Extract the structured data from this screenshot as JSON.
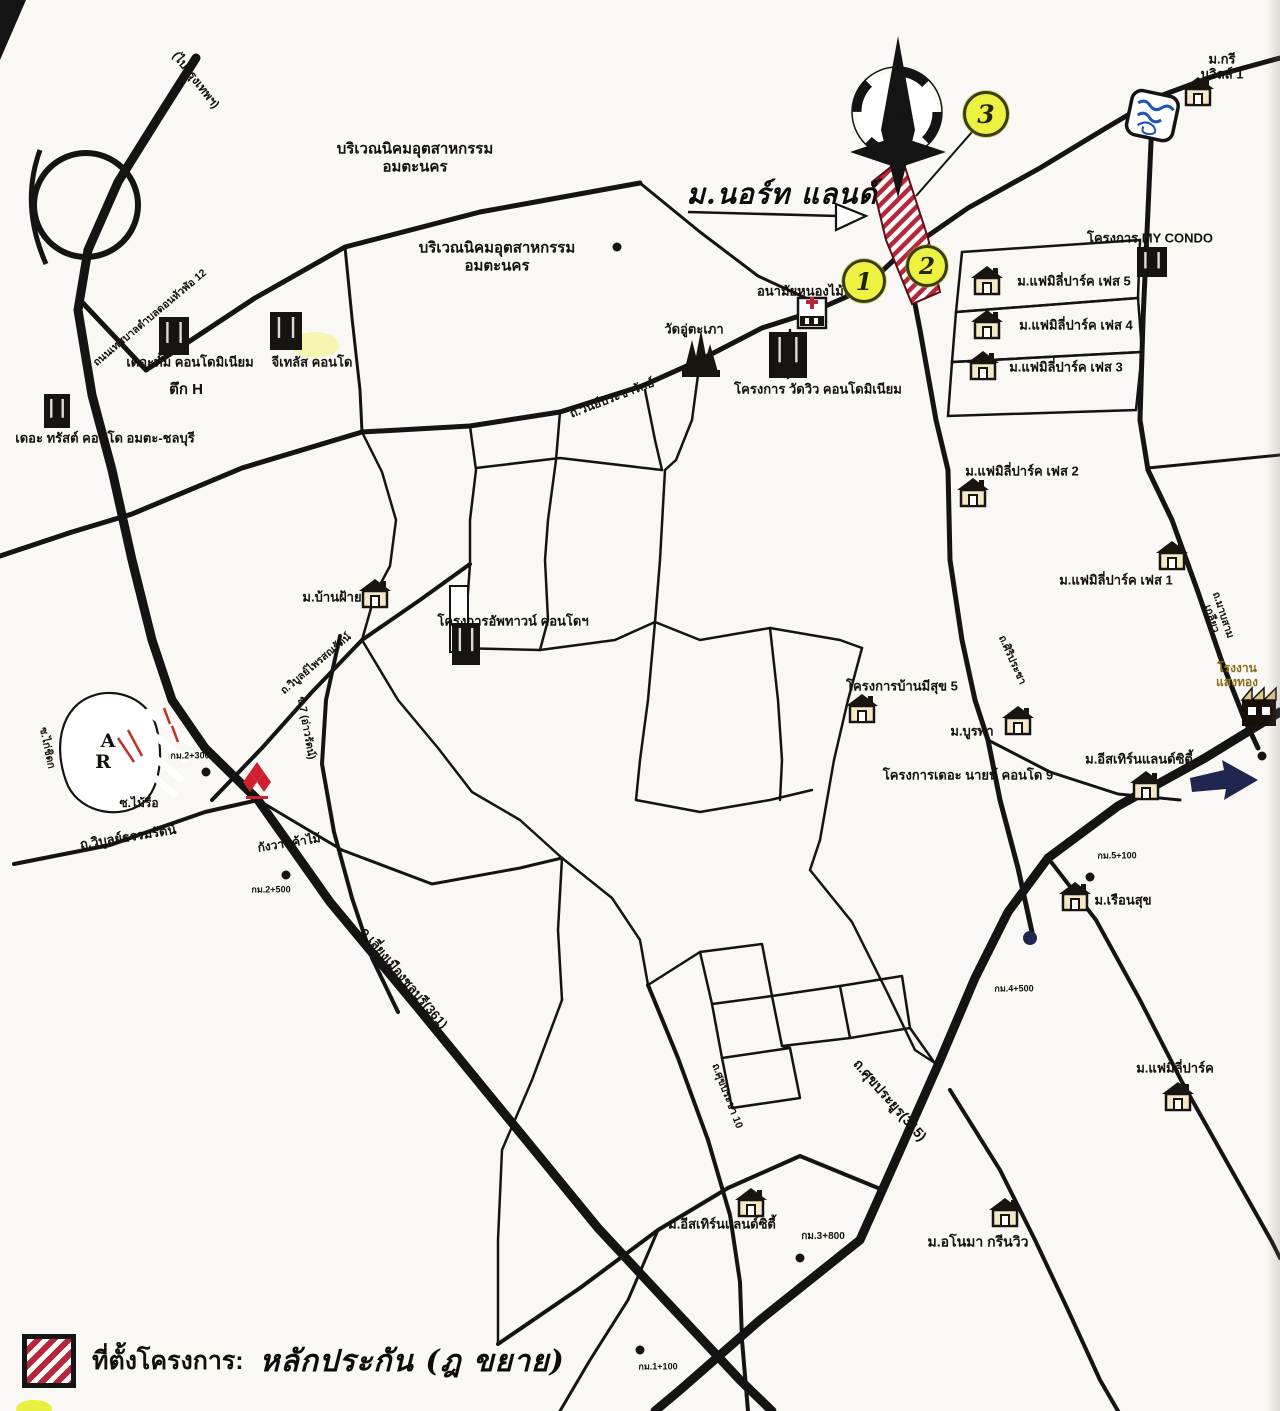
{
  "map": {
    "compass_label": "N",
    "site_annotation": "ม.นอร์ท แลนด์",
    "legend": {
      "swatch": "red-white-diagonal-stripes",
      "label_printed": "ที่ตั้งโครงการ:",
      "label_handwritten": "หลักประกัน (ฎ ขยาย)"
    },
    "colors": {
      "paper": "#f9f8f4",
      "road_black": "#141414",
      "hatch_red": "#b5283a",
      "highlight_yellow": "#edf240",
      "water_blue": "#2053b8",
      "arrow_navy": "#20264f",
      "mitsubishi_red": "#cf2030",
      "factory_text": "#8a6d1a"
    },
    "markers": [
      {
        "n": "1",
        "x": 864,
        "y": 281,
        "r": 19
      },
      {
        "n": "2",
        "x": 927,
        "y": 266,
        "r": 18
      },
      {
        "n": "3",
        "x": 986,
        "y": 114,
        "r": 20
      }
    ],
    "labels": [
      {
        "name": "industrial-estate-1",
        "text": "บริเวณนิคมอุตสาหกรรม\nอมตะนคร",
        "x": 415,
        "y": 158,
        "s": 15,
        "b": 1
      },
      {
        "name": "industrial-estate-2",
        "text": "บริเวณนิคมอุตสาหกรรม\nอมตะนคร",
        "x": 497,
        "y": 257,
        "s": 15,
        "b": 1
      },
      {
        "name": "to-bangkok",
        "text": "(ไปกรุงเทพฯ)",
        "x": 196,
        "y": 80,
        "s": 12,
        "b": 1,
        "r": 52
      },
      {
        "name": "road-thetsaban-12",
        "text": "ถนนเทศบาลตำบลดอนหัวฬ่อ 12",
        "x": 150,
        "y": 318,
        "s": 10.5,
        "b": 1,
        "r": -40
      },
      {
        "name": "the-thum-condo",
        "text": "เดอะทั้ม คอนโดมิเนียม",
        "x": 190,
        "y": 362,
        "s": 13,
        "b": 1
      },
      {
        "name": "tower-h",
        "text": "ตึก H",
        "x": 186,
        "y": 390,
        "s": 15,
        "b": 1
      },
      {
        "name": "g-plus-condo",
        "text": "จีเทลัส คอนโด",
        "x": 312,
        "y": 362,
        "s": 13,
        "b": 1
      },
      {
        "name": "the-trust-condo",
        "text": "เดอะ ทรัสต์ คอนโด อมตะ-ชลบุรี",
        "x": 105,
        "y": 438,
        "s": 13,
        "b": 1
      },
      {
        "name": "north-land-annotation",
        "text": "ม.นอร์ท แลนด์",
        "x": 782,
        "y": 194,
        "s": 28,
        "hw": 1
      },
      {
        "name": "green-ville-1",
        "text": "ม.กรีนวิลล์ 1",
        "x": 1222,
        "y": 67,
        "s": 13,
        "b": 1
      },
      {
        "name": "my-condo",
        "text": "โครงการ MY CONDO",
        "x": 1150,
        "y": 238,
        "s": 13,
        "b": 1
      },
      {
        "name": "family-park-5",
        "text": "ม.แฟมิลี่ปาร์ค เฟส 5",
        "x": 1074,
        "y": 281,
        "s": 13,
        "b": 1
      },
      {
        "name": "family-park-4",
        "text": "ม.แฟมิลี่ปาร์ค เฟส 4",
        "x": 1076,
        "y": 325,
        "s": 13,
        "b": 1
      },
      {
        "name": "family-park-3",
        "text": "ม.แฟมิลี่ปาร์ค เฟส 3",
        "x": 1066,
        "y": 367,
        "s": 13,
        "b": 1
      },
      {
        "name": "family-park-2",
        "text": "ม.แฟมิลี่ปาร์ค เฟส 2",
        "x": 1022,
        "y": 471,
        "s": 13,
        "b": 1
      },
      {
        "name": "family-park-1",
        "text": "ม.แฟมิลี่ปาร์ค เฟส 1",
        "x": 1116,
        "y": 580,
        "s": 13,
        "b": 1
      },
      {
        "name": "anamai-nong-mai-daeng",
        "text": "อนามัยหนองไม้แดง",
        "x": 812,
        "y": 291,
        "s": 13,
        "b": 1
      },
      {
        "name": "wat-u-taphao",
        "text": "วัดอู่ตะเภา",
        "x": 694,
        "y": 329,
        "s": 13,
        "b": 1
      },
      {
        "name": "wat-view-condo",
        "text": "โครงการ วัดวิว คอนโดมิเนียม",
        "x": 818,
        "y": 389,
        "s": 13,
        "b": 1
      },
      {
        "name": "road-winprachairak",
        "text": "ถ.วินย์ประชารักษ์",
        "x": 612,
        "y": 398,
        "s": 12,
        "b": 1,
        "r": -21
      },
      {
        "name": "ban-fai",
        "text": "ม.บ้านฝ้าย",
        "x": 332,
        "y": 597,
        "s": 13,
        "b": 1
      },
      {
        "name": "uptown-condo",
        "text": "โครงการอัพทาวน์ คอนโดฯ",
        "x": 513,
        "y": 621,
        "s": 13,
        "b": 1
      },
      {
        "name": "road-phaisonrat",
        "text": "ถ.วิบูลย์ไพรสณรัตน์",
        "x": 316,
        "y": 664,
        "s": 10.5,
        "b": 1,
        "r": -40
      },
      {
        "name": "soi-7",
        "text": "ซ.7 (อ่าวรัตน์)",
        "x": 306,
        "y": 728,
        "s": 10.5,
        "b": 1,
        "r": 80
      },
      {
        "name": "soi-kai-chidok",
        "text": "ซ.ไก่ชิดก",
        "x": 47,
        "y": 748,
        "s": 10.5,
        "b": 1,
        "r": 78
      },
      {
        "name": "letter-a",
        "text": "A",
        "x": 108,
        "y": 741,
        "s": 19,
        "serif": 1
      },
      {
        "name": "letter-r",
        "text": "R",
        "x": 103,
        "y": 762,
        "s": 19,
        "serif": 1
      },
      {
        "name": "km-2-300",
        "text": "กม.2+300",
        "x": 190,
        "y": 756,
        "s": 9,
        "b": 1
      },
      {
        "name": "soi-mai-rue",
        "text": "ซ.ไม้รื่อ",
        "x": 139,
        "y": 803,
        "s": 12,
        "b": 1
      },
      {
        "name": "road-wibun-thammarat",
        "text": "ถ.วิบูลย์ธรรมรัตน์",
        "x": 128,
        "y": 837,
        "s": 13,
        "b": 1,
        "r": -9
      },
      {
        "name": "kangwan-kha-mai",
        "text": "กังวานค้าไม้",
        "x": 289,
        "y": 843,
        "s": 12,
        "b": 1,
        "r": -9
      },
      {
        "name": "km-2-500",
        "text": "กม.2+500",
        "x": 271,
        "y": 890,
        "s": 9,
        "b": 1
      },
      {
        "name": "road-bypass-361",
        "text": "ถ.เลี่ยงเมืองชลบุรี(361)",
        "x": 404,
        "y": 978,
        "s": 13,
        "b": 1,
        "r": 50
      },
      {
        "name": "baan-mee-suk-5",
        "text": "โครงการบ้านมีสุข 5",
        "x": 902,
        "y": 686,
        "s": 13,
        "b": 1
      },
      {
        "name": "burapha",
        "text": "ม.บูรพา",
        "x": 972,
        "y": 731,
        "s": 13,
        "b": 1
      },
      {
        "name": "the-nine-condo-9",
        "text": "โครงการเดอะ นายน์ คอนโด 9",
        "x": 968,
        "y": 775,
        "s": 13,
        "b": 1
      },
      {
        "name": "eastern-land-city-1",
        "text": "ม.อีสเทิร์นแลนด์ซิตี้",
        "x": 1139,
        "y": 759,
        "s": 13,
        "b": 1
      },
      {
        "name": "road-siripracha",
        "text": "ถ.ศิริประชา",
        "x": 1012,
        "y": 660,
        "s": 10.5,
        "b": 1,
        "r": 66
      },
      {
        "name": "saeng-thong-factory",
        "text": "โรงงานแสงทอง",
        "x": 1237,
        "y": 675,
        "s": 12,
        "b": 1,
        "col": "#8a6d1a"
      },
      {
        "name": "road-mab-sam-kliao",
        "text": "ถ.มาบสามเกลียว",
        "x": 1217,
        "y": 617,
        "s": 10.5,
        "b": 1,
        "r": 72
      },
      {
        "name": "km-5-100",
        "text": "กม.5+100",
        "x": 1117,
        "y": 856,
        "s": 9,
        "b": 1
      },
      {
        "name": "ruen-suk",
        "text": "ม.เรือนสุข",
        "x": 1123,
        "y": 900,
        "s": 13,
        "b": 1
      },
      {
        "name": "km-4-500",
        "text": "กม.4+500",
        "x": 1014,
        "y": 989,
        "s": 9,
        "b": 1
      },
      {
        "name": "family-park-bottom-right",
        "text": "ม.แฟมิลี่ปาร์ค",
        "x": 1175,
        "y": 1068,
        "s": 13,
        "b": 1
      },
      {
        "name": "road-sukprayoon-315",
        "text": "ถ.ศุขประยูร(315)",
        "x": 890,
        "y": 1100,
        "s": 14,
        "b": 1,
        "r": 49
      },
      {
        "name": "road-sukpracha-10",
        "text": "ถ.ศุขประชา 10",
        "x": 727,
        "y": 1096,
        "s": 10.5,
        "b": 1,
        "r": 69
      },
      {
        "name": "eastern-land-city-2",
        "text": "ม.อีสเทิร์นแลนด์ซิตี้",
        "x": 722,
        "y": 1224,
        "s": 13,
        "b": 1
      },
      {
        "name": "km-3-800",
        "text": "กม.3+800",
        "x": 823,
        "y": 1237,
        "s": 10,
        "b": 1
      },
      {
        "name": "anoma-green-view",
        "text": "ม.อโนมา กรีนวิว",
        "x": 978,
        "y": 1242,
        "s": 14,
        "b": 1
      },
      {
        "name": "km-1-100",
        "text": "กม.1+100",
        "x": 658,
        "y": 1367,
        "s": 9,
        "b": 1
      }
    ],
    "house_icons": [
      {
        "x": 1198,
        "y": 92
      },
      {
        "x": 987,
        "y": 281
      },
      {
        "x": 987,
        "y": 325
      },
      {
        "x": 983,
        "y": 366
      },
      {
        "x": 973,
        "y": 493
      },
      {
        "x": 1172,
        "y": 556
      },
      {
        "x": 375,
        "y": 594
      },
      {
        "x": 862,
        "y": 709
      },
      {
        "x": 1018,
        "y": 721
      },
      {
        "x": 1146,
        "y": 786
      },
      {
        "x": 1075,
        "y": 897
      },
      {
        "x": 1178,
        "y": 1097
      },
      {
        "x": 751,
        "y": 1203
      },
      {
        "x": 1005,
        "y": 1213
      }
    ],
    "building_icons": [
      {
        "x": 174,
        "y": 336,
        "w": 30,
        "h": 38
      },
      {
        "x": 286,
        "y": 331,
        "w": 32,
        "h": 38
      },
      {
        "x": 57,
        "y": 411,
        "w": 26,
        "h": 34
      },
      {
        "x": 788,
        "y": 355,
        "w": 38,
        "h": 46
      },
      {
        "x": 1152,
        "y": 262,
        "w": 30,
        "h": 30
      },
      {
        "x": 466,
        "y": 644,
        "w": 28,
        "h": 42
      }
    ],
    "km_dots": [
      {
        "x": 206,
        "y": 772
      },
      {
        "x": 286,
        "y": 875
      },
      {
        "x": 1090,
        "y": 877
      },
      {
        "x": 1262,
        "y": 756
      },
      {
        "x": 800,
        "y": 1258
      },
      {
        "x": 640,
        "y": 1350
      },
      {
        "x": 617,
        "y": 247
      }
    ],
    "navy_dot": {
      "x": 1030,
      "y": 938
    }
  }
}
